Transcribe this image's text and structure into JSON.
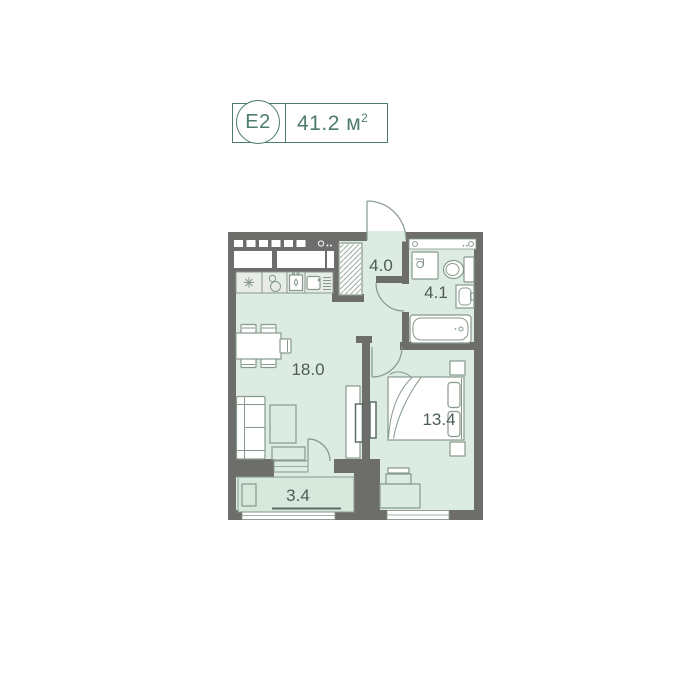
{
  "badge": {
    "unit": "E2",
    "area": "41.2 м",
    "area_sup": "2"
  },
  "rooms": {
    "hallway": {
      "label": "4.0"
    },
    "bathroom": {
      "label": "4.1"
    },
    "living": {
      "label": "18.0"
    },
    "bedroom": {
      "label": "13.4"
    },
    "balcony": {
      "label": "3.4"
    }
  },
  "colors": {
    "wall": "#6d6d6b",
    "room_fill": "#ddece2",
    "balcony_fill": "#d7e8dd",
    "furniture_stroke": "#86998c",
    "furniture_dark": "#5d6d64",
    "label_text": "#4d5d54",
    "badge_green": "#4d7c6b",
    "counter_fill": "#e7ece7"
  }
}
